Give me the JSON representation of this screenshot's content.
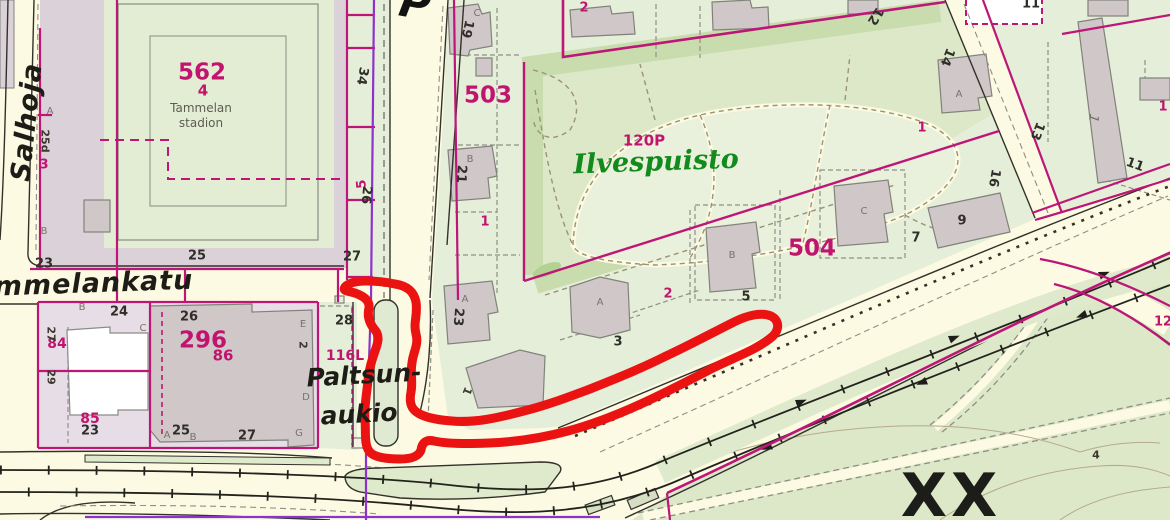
{
  "map": {
    "park_name": "Ilvespuisto",
    "park_code": "120P",
    "stadium_name": "Tammelan stadion",
    "plaza_name": "Paltsunaukio",
    "street_names": [
      "Salhoja",
      "ammelankatu"
    ],
    "district_numbers": [
      "562",
      "503",
      "504",
      "296"
    ],
    "special_marker": "XX",
    "colors": {
      "street_fill": "#fcfae2",
      "block_green": "#e5eed9",
      "park_green": "#dde8c9",
      "park_dark_band": "#c8dcae",
      "lawn_light": "#e9f0db",
      "pink_block_562": "#dbd1d8",
      "pink_block_296": "#e7dde7",
      "building_fill": "#cfc7c8",
      "building_stroke": "#81827a",
      "boundary_magenta": "#bd1677",
      "boundary_purple": "#8d33cc",
      "highlight_red": "#eb1312",
      "road_black": "#32322b",
      "parcel_dash_gray": "#8f8f85",
      "path_olive": "#9a9374",
      "park_text_green": "#128a1c"
    }
  },
  "labels": [
    {
      "t": "Salhoja",
      "x": 27,
      "y": 122,
      "cls": "street",
      "rot": -84
    },
    {
      "t": "ammelankatu",
      "x": 84,
      "y": 284,
      "cls": "street",
      "rot": -2
    },
    {
      "t": "P",
      "x": 415,
      "y": 4,
      "cls": "cutglyph",
      "rot": 10
    },
    {
      "t": "Paltsun-",
      "x": 364,
      "y": 375,
      "cls": "street2",
      "rot": -3
    },
    {
      "t": "aukio",
      "x": 359,
      "y": 414,
      "cls": "street2",
      "rot": -3
    },
    {
      "t": "Ilvespuisto",
      "x": 656,
      "y": 162,
      "cls": "park",
      "rot": -2
    },
    {
      "t": "120P",
      "x": 644,
      "y": 141,
      "cls": "magmd"
    },
    {
      "t": "562",
      "x": 202,
      "y": 73,
      "cls": "maglg"
    },
    {
      "t": "4",
      "x": 203,
      "y": 91,
      "cls": "magmd"
    },
    {
      "t": "Tammelan",
      "x": 201,
      "y": 108,
      "cls": "stad"
    },
    {
      "t": "stadion",
      "x": 201,
      "y": 123,
      "cls": "stad"
    },
    {
      "t": "503",
      "x": 488,
      "y": 96,
      "cls": "maglg"
    },
    {
      "t": "296",
      "x": 203,
      "y": 341,
      "cls": "maglg"
    },
    {
      "t": "86",
      "x": 223,
      "y": 356,
      "cls": "magmd"
    },
    {
      "t": "504",
      "x": 812,
      "y": 249,
      "cls": "maglg"
    },
    {
      "t": "84",
      "x": 57,
      "y": 344,
      "cls": "magmd2"
    },
    {
      "t": "85",
      "x": 90,
      "y": 419,
      "cls": "magmd2"
    },
    {
      "t": "116L",
      "x": 345,
      "y": 356,
      "cls": "magmd2"
    },
    {
      "t": "3",
      "x": 44,
      "y": 165,
      "cls": "magsm"
    },
    {
      "t": "1",
      "x": 485,
      "y": 222,
      "cls": "magsm"
    },
    {
      "t": "2",
      "x": 668,
      "y": 294,
      "cls": "magsm"
    },
    {
      "t": "2",
      "x": 584,
      "y": 8,
      "cls": "magsm"
    },
    {
      "t": "1",
      "x": 922,
      "y": 128,
      "cls": "magsm"
    },
    {
      "t": "1",
      "x": 1163,
      "y": 107,
      "cls": "magsm"
    },
    {
      "t": "12",
      "x": 1163,
      "y": 322,
      "cls": "magsm"
    },
    {
      "t": "5",
      "x": 362,
      "y": 184,
      "cls": "magsm",
      "rot": -95
    },
    {
      "t": "25",
      "x": 197,
      "y": 256,
      "cls": "blk"
    },
    {
      "t": "23",
      "x": 44,
      "y": 264,
      "cls": "blk"
    },
    {
      "t": "24",
      "x": 119,
      "y": 312,
      "cls": "blk"
    },
    {
      "t": "26",
      "x": 189,
      "y": 317,
      "cls": "blk"
    },
    {
      "t": "23",
      "x": 90,
      "y": 431,
      "cls": "blk"
    },
    {
      "t": "25",
      "x": 181,
      "y": 431,
      "cls": "blk"
    },
    {
      "t": "27",
      "x": 247,
      "y": 436,
      "cls": "blk"
    },
    {
      "t": "27",
      "x": 352,
      "y": 257,
      "cls": "blk"
    },
    {
      "t": "28",
      "x": 344,
      "y": 321,
      "cls": "blk"
    },
    {
      "t": "34",
      "x": 362,
      "y": 76,
      "cls": "blk",
      "rot": 100
    },
    {
      "t": "26",
      "x": 366,
      "y": 195,
      "cls": "blk",
      "rot": 95
    },
    {
      "t": "27",
      "x": 51,
      "y": 334,
      "cls": "blksm",
      "rot": 90
    },
    {
      "t": "29",
      "x": 51,
      "y": 377,
      "cls": "blksm",
      "rot": 90
    },
    {
      "t": "2",
      "x": 303,
      "y": 345,
      "cls": "blksm",
      "rot": 90
    },
    {
      "t": "25d",
      "x": 45,
      "y": 141,
      "cls": "blksm",
      "rot": 90
    },
    {
      "t": "19",
      "x": 467,
      "y": 29,
      "cls": "blk",
      "rot": 103
    },
    {
      "t": "21",
      "x": 461,
      "y": 174,
      "cls": "blk",
      "rot": 93
    },
    {
      "t": "23",
      "x": 458,
      "y": 317,
      "cls": "blk",
      "rot": 95
    },
    {
      "t": "3",
      "x": 618,
      "y": 342,
      "cls": "blk"
    },
    {
      "t": "5",
      "x": 746,
      "y": 297,
      "cls": "blk"
    },
    {
      "t": "7",
      "x": 916,
      "y": 238,
      "cls": "blk"
    },
    {
      "t": "9",
      "x": 962,
      "y": 221,
      "cls": "blk"
    },
    {
      "t": "13",
      "x": 1037,
      "y": 131,
      "cls": "blk",
      "rot": 112
    },
    {
      "t": "16",
      "x": 994,
      "y": 178,
      "cls": "blk",
      "rot": 100
    },
    {
      "t": "12",
      "x": 875,
      "y": 16,
      "cls": "blk",
      "rot": 122
    },
    {
      "t": "14",
      "x": 947,
      "y": 57,
      "cls": "blk",
      "rot": 112
    },
    {
      "t": "11",
      "x": 1031,
      "y": 4,
      "cls": "blk"
    },
    {
      "t": "11",
      "x": 1135,
      "y": 165,
      "cls": "blk",
      "rot": 20
    },
    {
      "t": "1",
      "x": 467,
      "y": 391,
      "cls": "blksm",
      "rot": 112
    },
    {
      "t": "4",
      "x": 1096,
      "y": 455,
      "cls": "blksm"
    },
    {
      "t": "C",
      "x": 477,
      "y": 14,
      "cls": "gry"
    },
    {
      "t": "B",
      "x": 470,
      "y": 160,
      "cls": "gry"
    },
    {
      "t": "A",
      "x": 465,
      "y": 300,
      "cls": "gry"
    },
    {
      "t": "A",
      "x": 600,
      "y": 303,
      "cls": "gry"
    },
    {
      "t": "B",
      "x": 732,
      "y": 256,
      "cls": "gry"
    },
    {
      "t": "C",
      "x": 864,
      "y": 212,
      "cls": "gry"
    },
    {
      "t": "A",
      "x": 959,
      "y": 95,
      "cls": "gry"
    },
    {
      "t": "A",
      "x": 50,
      "y": 112,
      "cls": "gry"
    },
    {
      "t": "B",
      "x": 44,
      "y": 232,
      "cls": "gry"
    },
    {
      "t": "B",
      "x": 82,
      "y": 308,
      "cls": "gry"
    },
    {
      "t": "C",
      "x": 143,
      "y": 329,
      "cls": "gry"
    },
    {
      "t": "E",
      "x": 303,
      "y": 325,
      "cls": "gry"
    },
    {
      "t": "D",
      "x": 306,
      "y": 398,
      "cls": "gry"
    },
    {
      "t": "G",
      "x": 299,
      "y": 434,
      "cls": "gry"
    },
    {
      "t": "A",
      "x": 167,
      "y": 436,
      "cls": "gry"
    },
    {
      "t": "B",
      "x": 193,
      "y": 438,
      "cls": "gry"
    },
    {
      "t": "1",
      "x": 1093,
      "y": 118,
      "cls": "gryit",
      "rot": 100
    },
    {
      "t": "XX",
      "x": 951,
      "y": 496,
      "cls": "xx"
    }
  ]
}
